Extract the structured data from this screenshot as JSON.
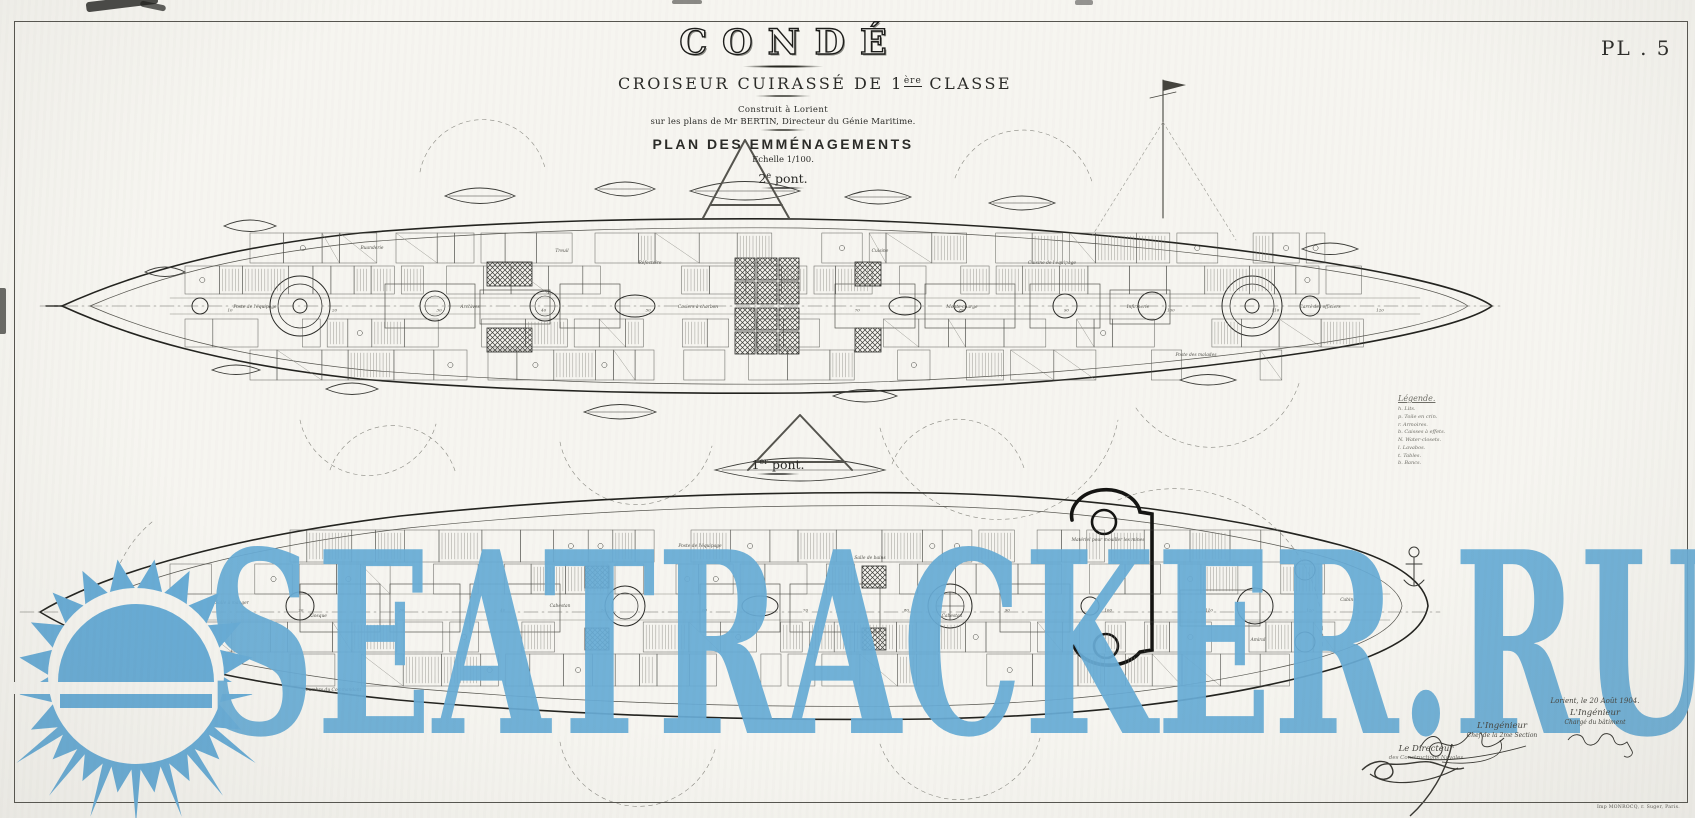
{
  "plate": {
    "number": "PL . 5"
  },
  "title_block": {
    "ship_name": "CONDÉ",
    "type_line_pre": "CROISEUR CUIRASSÉ DE 1",
    "type_line_sup": "ère",
    "type_line_post": " CLASSE",
    "built_line": "Construit à Lorient",
    "plans_line": "sur les plans de Mr BERTIN, Directeur du Génie Maritime.",
    "plan_title": "PLAN DES EMMÉNAGEMENTS",
    "scale_line": "Echelle 1/100.",
    "deck_upper": {
      "num": "2",
      "sup": "e",
      "word": " pont."
    }
  },
  "deck_lower": {
    "num": "1",
    "sup": "er",
    "word": " pont."
  },
  "legend": {
    "heading": "Légende.",
    "items": [
      "h.  Lits.",
      "p.  Toile en crin.",
      "r.  Armoires.",
      "b.  Caisses à effets.",
      "N.  Water-closets.",
      "l.  Lavabos.",
      "t.  Tables.",
      "b.  Bancs."
    ]
  },
  "signatures": {
    "date_line": "Lorient, le 20 Août 1904.",
    "engineer_title": "L'Ingénieur",
    "engineer_sub": "Chargé du bâtiment",
    "section_title": "L'Ingénieur",
    "section_sub": "Chef de la 2me Section",
    "director_title": "Le Directeur",
    "director_sub": "des Constructions Navales"
  },
  "printer_line": "Imp MONROCQ, r. Suger, Paris.",
  "watermark": {
    "text": "SEATRACKER.RU",
    "color": "#68acd6"
  },
  "diagram": {
    "upper_labels": [
      {
        "x": 255,
        "y": 308,
        "t": "Poste de l'équipage"
      },
      {
        "x": 372,
        "y": 249,
        "t": "Buanderie"
      },
      {
        "x": 470,
        "y": 308,
        "t": "Archives"
      },
      {
        "x": 562,
        "y": 252,
        "t": "Treuil"
      },
      {
        "x": 650,
        "y": 264,
        "t": "Réfectoire"
      },
      {
        "x": 698,
        "y": 308,
        "t": "Casiers à charbon"
      },
      {
        "x": 880,
        "y": 252,
        "t": "Cuisine"
      },
      {
        "x": 962,
        "y": 308,
        "t": "Monte-charge"
      },
      {
        "x": 1052,
        "y": 264,
        "t": "Cuisine de l'équipage"
      },
      {
        "x": 1138,
        "y": 308,
        "t": "Infirmerie"
      },
      {
        "x": 1196,
        "y": 356,
        "t": "Poste des malades"
      },
      {
        "x": 1320,
        "y": 308,
        "t": "Carré des officiers"
      }
    ],
    "lower_labels": [
      {
        "x": 232,
        "y": 604,
        "t": "Salle à manger"
      },
      {
        "x": 205,
        "y": 657,
        "t": "Commandant"
      },
      {
        "x": 318,
        "y": 617,
        "t": "Kiosque"
      },
      {
        "x": 332,
        "y": 691,
        "t": "Chambre du Commandant"
      },
      {
        "x": 560,
        "y": 607,
        "t": "Cabestan"
      },
      {
        "x": 700,
        "y": 547,
        "t": "Poste de l'équipage"
      },
      {
        "x": 870,
        "y": 559,
        "t": "Salle de bains"
      },
      {
        "x": 952,
        "y": 617,
        "t": "Cabestan"
      },
      {
        "x": 1108,
        "y": 541,
        "t": "Matériel pour mouiller les mines"
      },
      {
        "x": 1258,
        "y": 641,
        "t": "Amiral"
      },
      {
        "x": 1348,
        "y": 601,
        "t": "Cabine"
      }
    ],
    "frame_numbers": [
      "10",
      "20",
      "30",
      "40",
      "50",
      "60",
      "70",
      "80",
      "90",
      "100",
      "110",
      "120"
    ]
  }
}
